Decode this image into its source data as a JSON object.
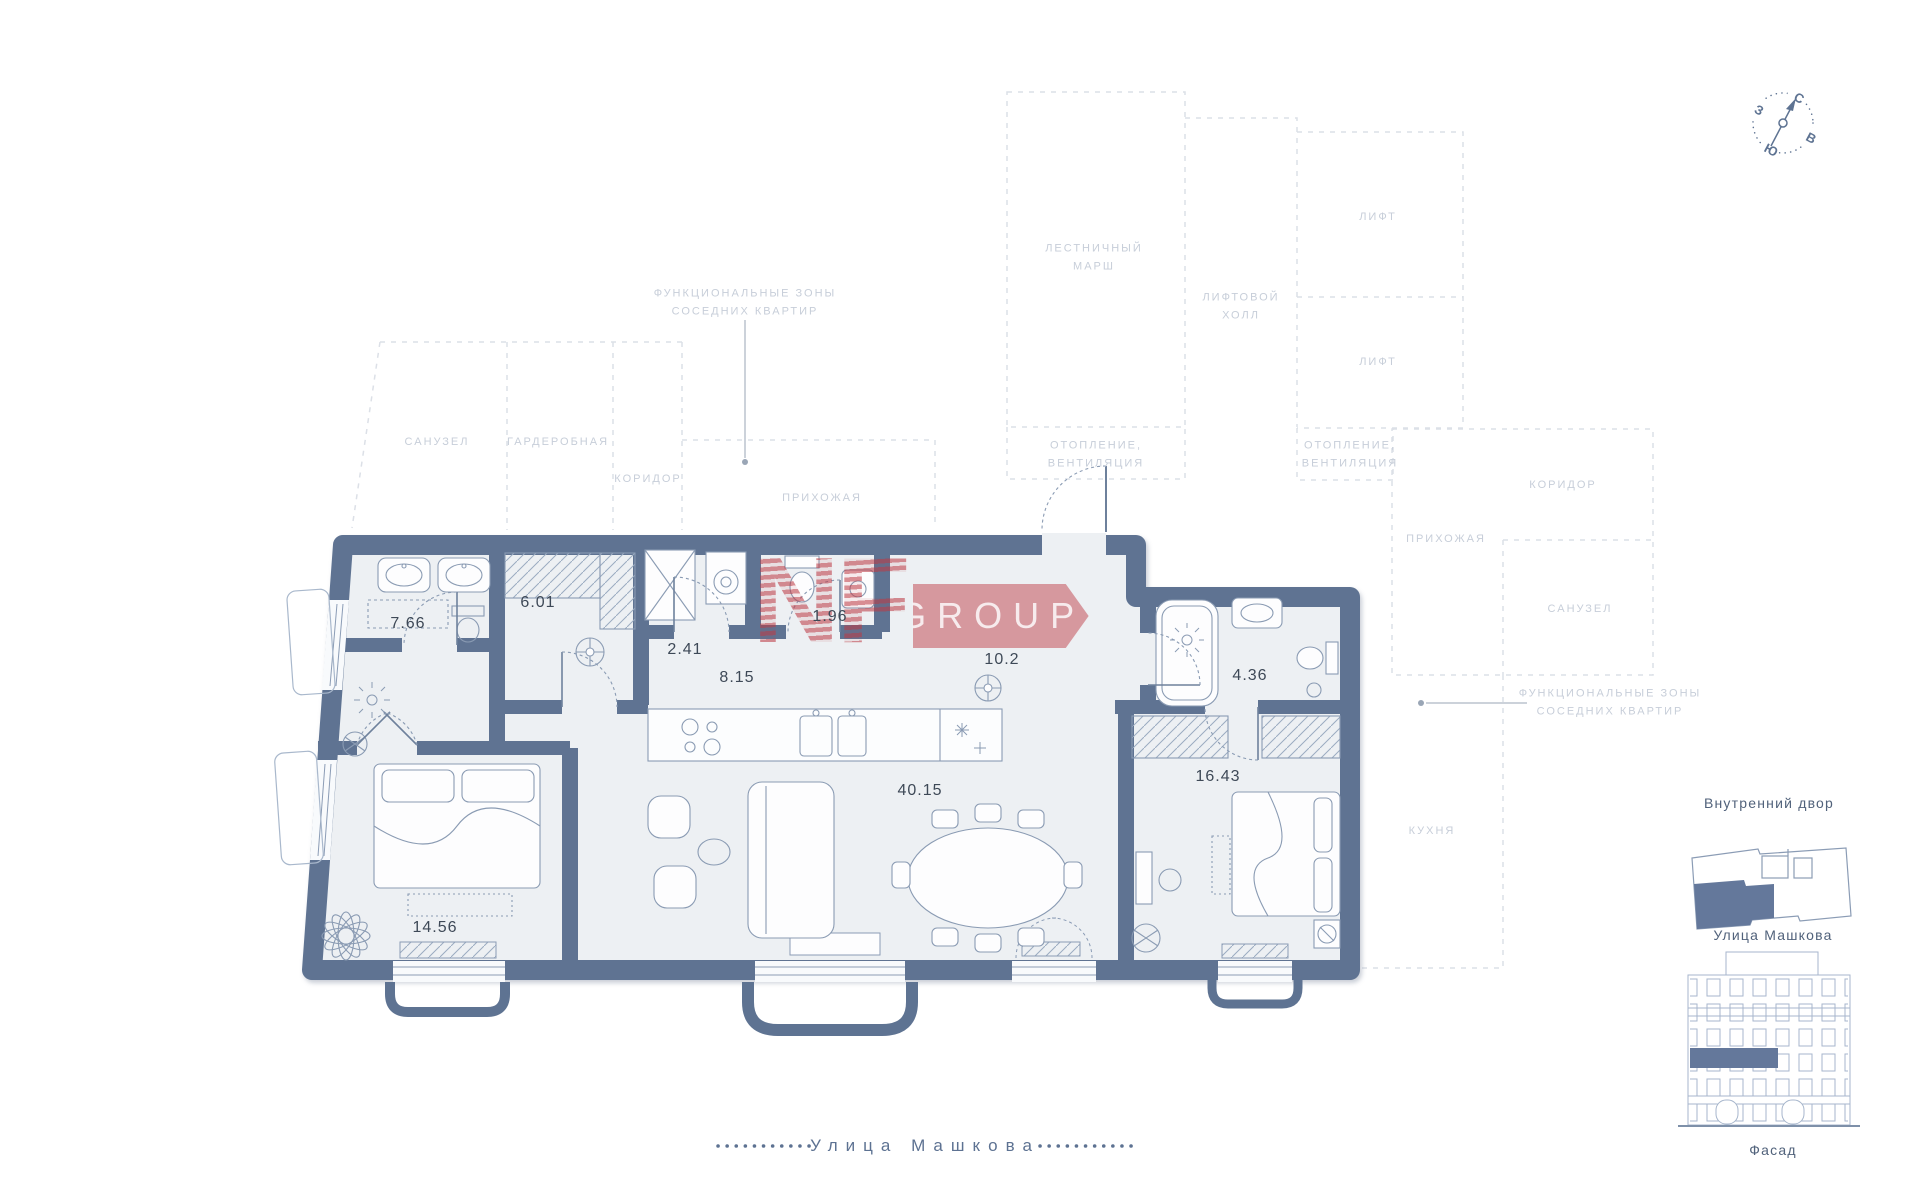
{
  "page": {
    "type": "apartment-floor-plan"
  },
  "colors": {
    "wall": "#5E7392",
    "room_fill": "#EDF0F3",
    "furniture_line": "#8A9BB3",
    "dashed_zone": "#DCE0E7",
    "zone_label": "#C7CED9",
    "area_label": "#3E4957",
    "logo_red": "#BD3A44",
    "highlight_fill": "#64789B",
    "facade_line": "#A7B6CC",
    "street_text": "#5D7292"
  },
  "watermark": {
    "brand": "NF",
    "suffix": "GROUP"
  },
  "compass": {
    "north": "С",
    "east": "В",
    "south": "Ю",
    "west": "З"
  },
  "labels": {
    "functional_zones": "ФУНКЦИОНАЛЬНЫЕ ЗОНЫ\nСОСЕДНИХ КВАРТИР",
    "bathroom": "САНУЗЕЛ",
    "wardrobe": "ГАРДЕРОБНАЯ",
    "corridor": "КОРИДОР",
    "hallway": "ПРИХОЖАЯ",
    "stairs": "ЛЕСТНИЧНЫЙ\nМАРШ",
    "elevator_hall": "ЛИФТОВОЙ\nХОЛЛ",
    "elevator": "ЛИФТ",
    "heating": "ОТОПЛЕНИЕ,\nВЕНТИЛЯЦИЯ",
    "kitchen": "КУХНЯ"
  },
  "rooms": [
    {
      "name": "bathroom-master",
      "area": "7.66"
    },
    {
      "name": "wardrobe-room",
      "area": "6.01"
    },
    {
      "name": "storage",
      "area": "2.41"
    },
    {
      "name": "wc",
      "area": "1.96"
    },
    {
      "name": "corridor",
      "area": "8.15"
    },
    {
      "name": "entrance-hall",
      "area": "10.2"
    },
    {
      "name": "bathroom-guest",
      "area": "4.36"
    },
    {
      "name": "living-kitchen",
      "area": "40.15"
    },
    {
      "name": "bedroom-master",
      "area": "14.56"
    },
    {
      "name": "bedroom",
      "area": "16.43"
    }
  ],
  "street": {
    "label": "Улица Машкова"
  },
  "sidebar": {
    "courtyard": "Внутренний двор",
    "street": "Улица Машкова",
    "facade": "Фасад"
  }
}
